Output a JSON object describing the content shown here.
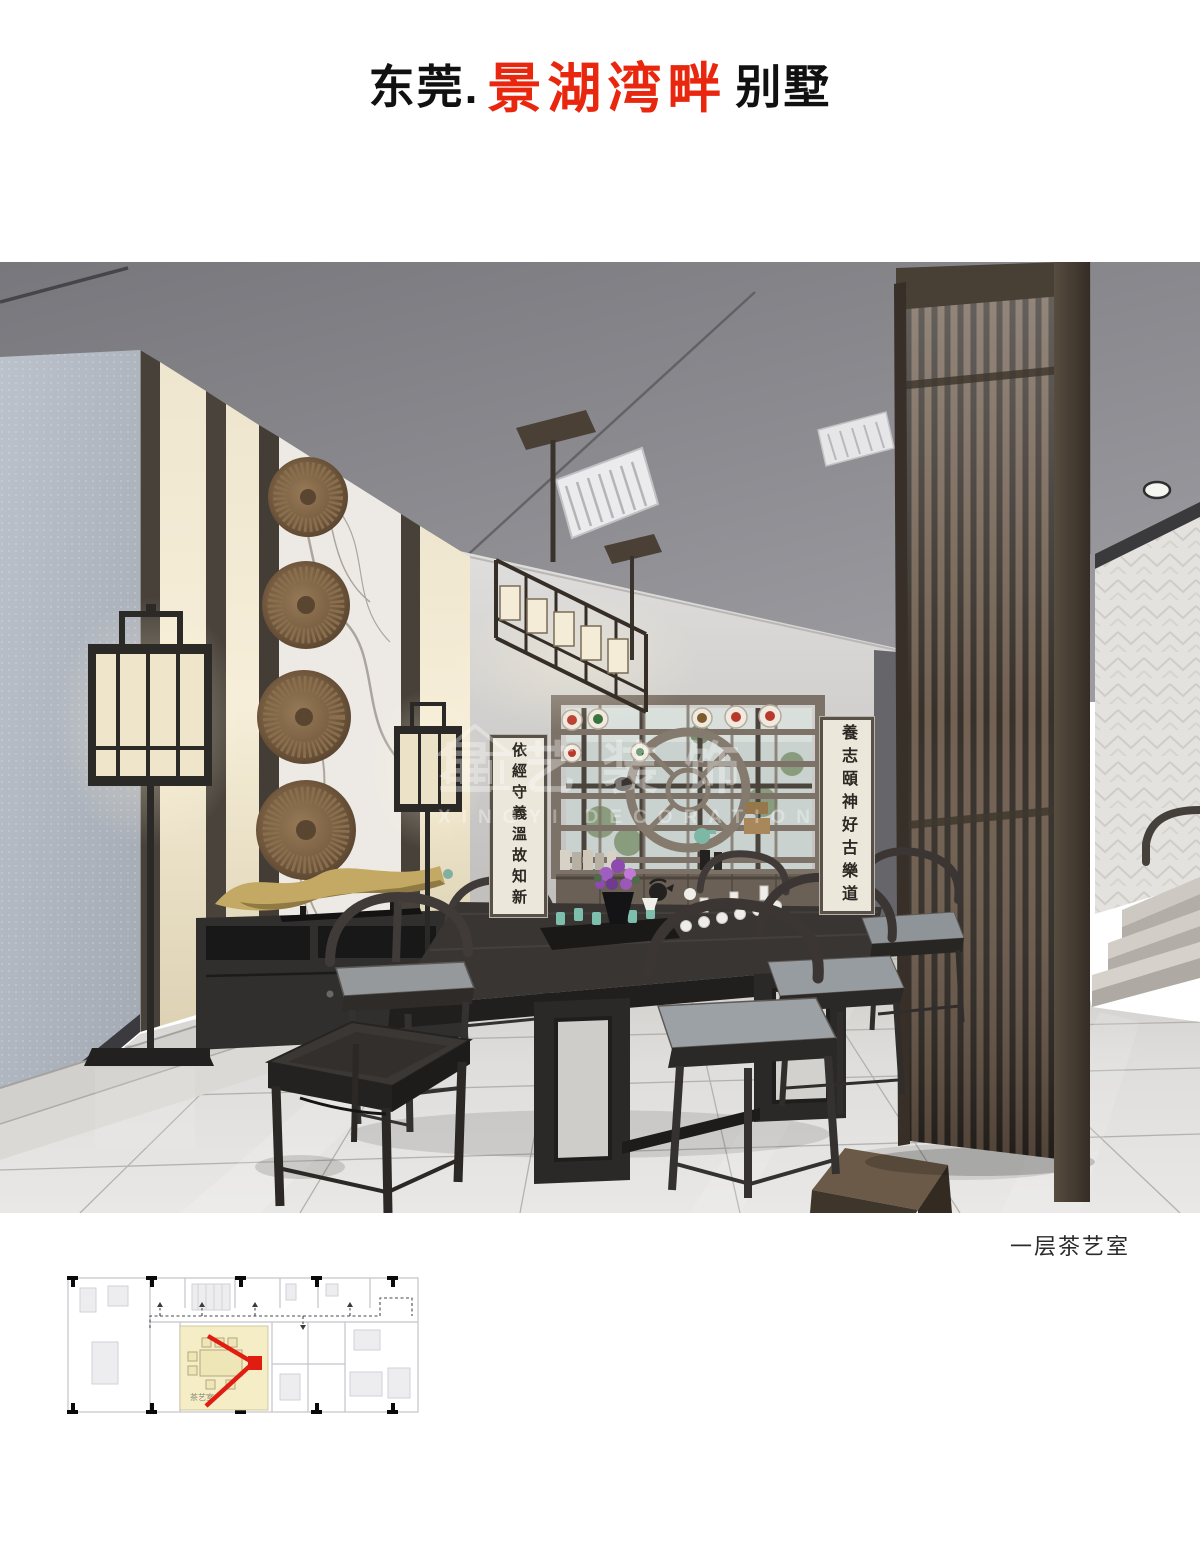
{
  "page": {
    "title": {
      "prefix": "东莞.",
      "highlight": "景湖湾畔",
      "suffix": "别墅"
    },
    "caption": "一层茶艺室"
  },
  "photo": {
    "watermark": {
      "cn": "星艺装饰",
      "en": "XINGYI DECORATION"
    },
    "scrolls": {
      "left": "依經守義溫故知新",
      "right": "養志頤神好古樂道"
    }
  },
  "floor_plan": {
    "room_label": "茶艺室"
  },
  "colors": {
    "title_red": "#e8270e",
    "plan_arrow_red": "#e01d10",
    "plan_room_highlight": "#f4edc6",
    "ceiling_gray": "#8e8e93",
    "wood_dark": "#2e2c2b",
    "screen_walnut": "#6b5949"
  }
}
